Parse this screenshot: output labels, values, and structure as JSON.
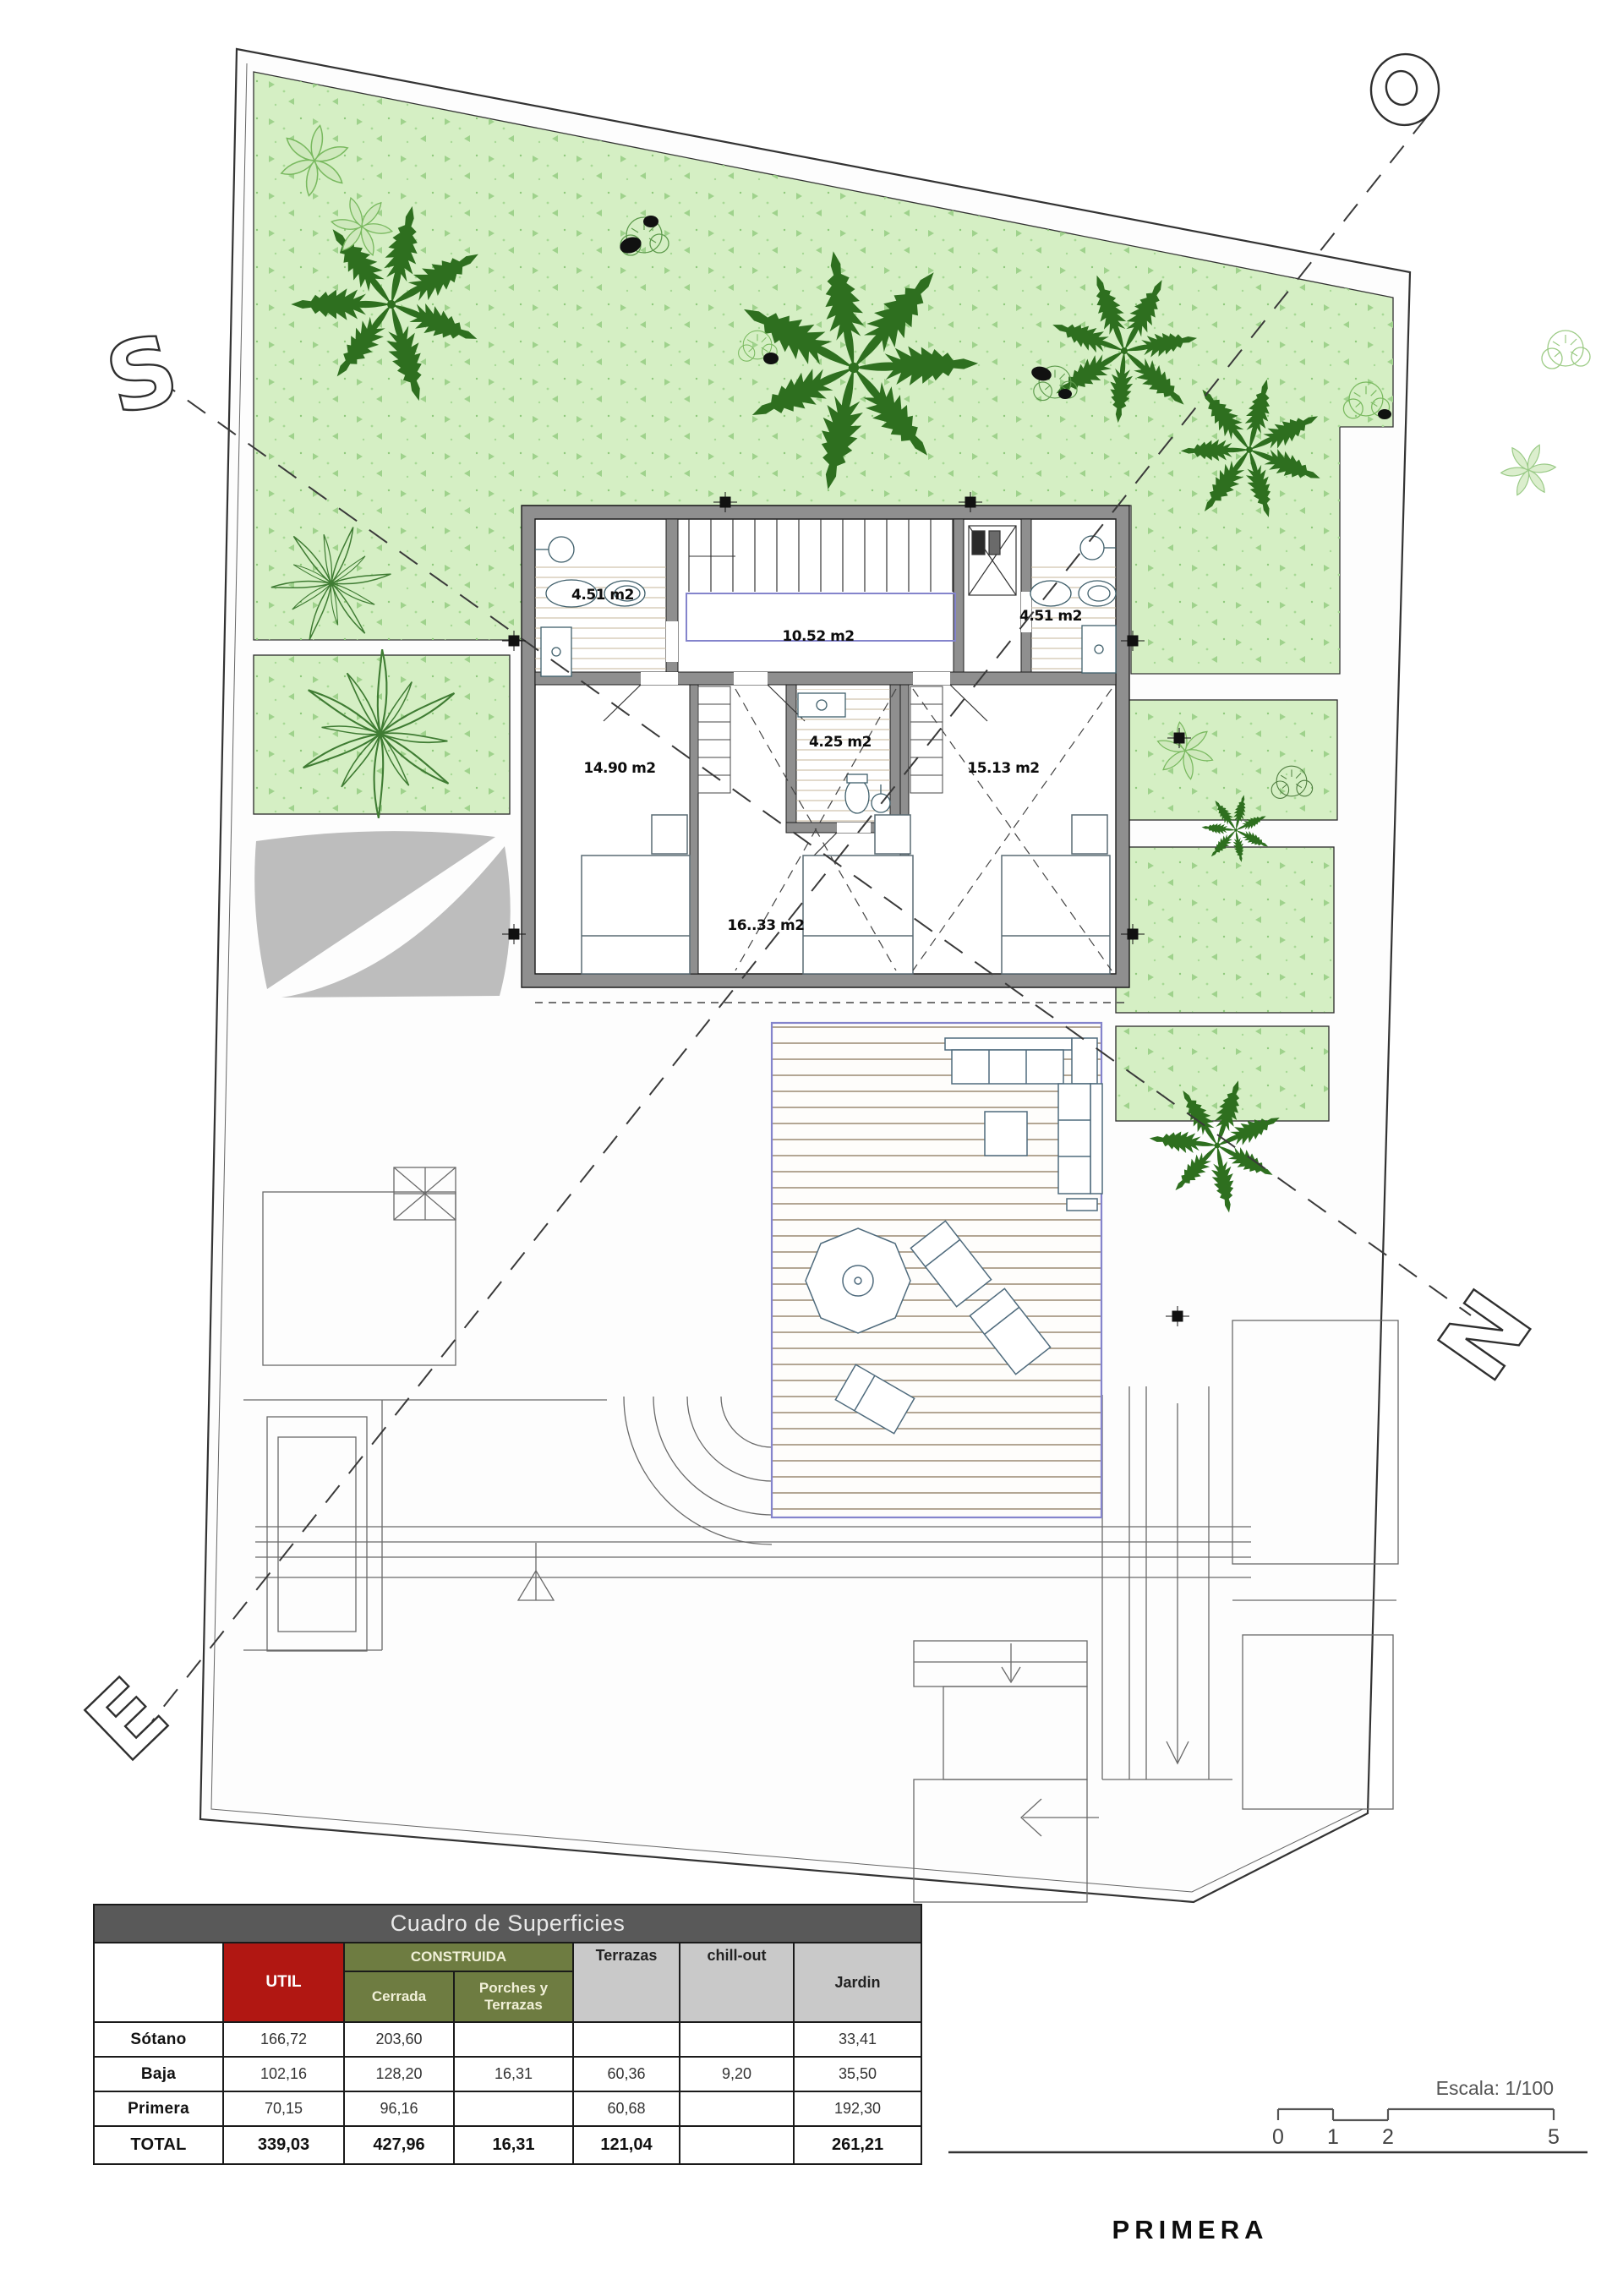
{
  "plan": {
    "rooms": [
      {
        "label": "4.51 m2"
      },
      {
        "label": "10.52 m2"
      },
      {
        "label": "4.51 m2"
      },
      {
        "label": "14.90 m2"
      },
      {
        "label": "4.25 m2"
      },
      {
        "label": "15.13 m2"
      },
      {
        "label": "16..33 m2"
      }
    ],
    "compass": {
      "west": "O",
      "south": "S",
      "north": "N",
      "east": "E"
    },
    "colors": {
      "garden_green": "#d5efc4",
      "speckle_green": "#9fd28c",
      "palm_green": "#2e6f1f",
      "light_plant_green": "#79b95f",
      "wall_gray": "#8f8f8f",
      "deck_line_brown": "#9a8a72",
      "rail_purple": "#8484cc",
      "sail_gray": "#bdbdbd"
    }
  },
  "scalebar": {
    "label": "Escala: 1/100",
    "ticks": [
      "0",
      "1",
      "2",
      "5"
    ]
  },
  "footer": {
    "plan_name": "PRIMERA"
  },
  "table": {
    "title": "Cuadro de Superficies",
    "headers": {
      "util": "UTIL",
      "construida": "CONSTRUIDA",
      "cerrada": "Cerrada",
      "porches": "Porches y Terrazas",
      "terrazas": "Terrazas",
      "chillout": "chill-out",
      "jardin": "Jardin"
    },
    "rows": [
      {
        "name": "Sótano",
        "util": "166,72",
        "cerrada": "203,60",
        "porches": "",
        "terrazas": "",
        "chillout": "",
        "jardin": "33,41"
      },
      {
        "name": "Baja",
        "util": "102,16",
        "cerrada": "128,20",
        "porches": "16,31",
        "terrazas": "60,36",
        "chillout": "9,20",
        "jardin": "35,50"
      },
      {
        "name": "Primera",
        "util": "70,15",
        "cerrada": "96,16",
        "porches": "",
        "terrazas": "60,68",
        "chillout": "",
        "jardin": "192,30"
      },
      {
        "name": "TOTAL",
        "util": "339,03",
        "cerrada": "427,96",
        "porches": "16,31",
        "terrazas": "121,04",
        "chillout": "",
        "jardin": "261,21"
      }
    ],
    "colors": {
      "title_bg": "#595959",
      "util_bg": "#b11712",
      "construida_bg": "#6e7c41",
      "muted_header_bg": "#c9c9c9"
    }
  }
}
